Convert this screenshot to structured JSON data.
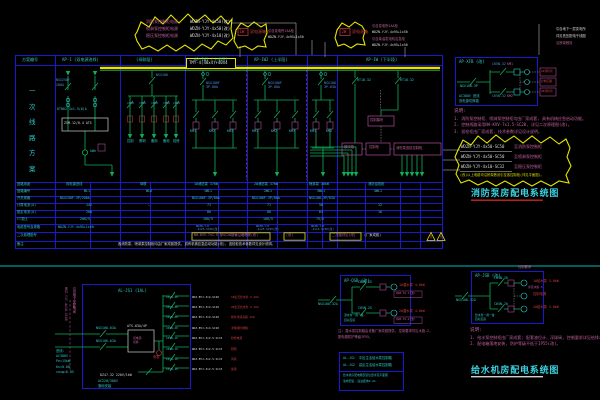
{
  "top": {
    "cloud1": {
      "l1": "消防泵控制柜电源",
      "s1": "WDZN-YJY-4x50(改)",
      "l2": "喷淋泵控制柜电源",
      "s2": "WDZN-YJY-4x50(改)",
      "l3": "稳压泵控制柜电源",
      "s3": "WDZN-YJY-4x10(改)"
    },
    "cloud2_tag": "1W",
    "cloud2_text": "双电源箱",
    "cloud3_tag": "2W",
    "cloud3_text": "双电源箱",
    "pairA1": "引自变电所1AA柜",
    "pairA2": "WDZN-YJY-4x95+1x50",
    "pairB1": "引自变电所2AA柜",
    "pairB2": "WDZN-YJY-4x95+1x50",
    "pairB3": "引自柴油发电机应急柜",
    "pairB4": "WDZN-YJY-4x95+1x50",
    "corner1": "引自地下一层变电所",
    "corner2": "详见低压配电干线图",
    "corner3": "沿桥架敷设"
  },
  "main": {
    "scheme_label": "一\n次\n线\n路\n方\n案",
    "h0": "方案编号",
    "h1": "AP-1 (双电源进线)",
    "h2": "(母联段)",
    "h3": "AP-1W1 (上半段)",
    "h4": "AP-1W2 (上半段)",
    "h5": "AP-1W (下半段)",
    "busbar_label": "TMY-4(40x4)+40x4",
    "inc_b1": "NSX250F",
    "inc_b2": "200A",
    "inc_meter": "DT862 3x1.5(6)A",
    "inc_box": "ZSM-12/0.4 ATS",
    "inc_out": "kWh",
    "f_brk": "NSX100",
    "f1": "C65N",
    "f2": "C65N",
    "f3": "C65N",
    "f4": "C65N",
    "f5": "C65N",
    "u1": "控制",
    "u2": "照明",
    "u3": "备用",
    "u4": "备用",
    "u5": "检修",
    "m1_brk": "NSX100F\n3P-80A",
    "m2_brk": "NSX100F\n3P-80A",
    "m3_brk": "NSX100\n3P-63A",
    "m1_k1": "KM1",
    "m1_k2": "KM2",
    "m1_k3": "KM3",
    "m2_k1": "KM1",
    "m2_k2": "KM2",
    "m2_k3": "KM3",
    "m3_k1": "KM1",
    "m3_k2": "KM2",
    "sub_f1": "RT18-32",
    "sub_f2": "RT18-32",
    "sub_box1": "控制模块",
    "sub_box2": "模块箱",
    "sub_box3": "控制柜",
    "sub_box4": "消防泵巡检控制柜",
    "rows": [
      {
        "label": "回路用途",
        "c": [
          "双电源进线",
          "母联",
          "1#消防泵 37kW",
          "2#消防泵 37kW",
          "喷淋泵 30kW",
          "消防巡检柜"
        ]
      },
      {
        "label": "回路编号",
        "c": [
          "WL1",
          "WL0",
          "1WL1",
          "2WL1",
          "3WL1",
          "4WL1"
        ]
      },
      {
        "label": "开关规格",
        "c": [
          "NSX250F-3P/200A",
          "",
          "NSX100F-3P/80A",
          "NSX100F-3P/80A",
          "NSX100-3P/63A",
          ""
        ]
      },
      {
        "label": "计算电流(A)",
        "c": [
          "142",
          "—",
          "71",
          "71",
          "58",
          "12"
        ]
      },
      {
        "label": "整定电流(A)",
        "c": [
          "200",
          "",
          "80",
          "80",
          "63",
          "16"
        ]
      },
      {
        "label": "CT变比",
        "c": [
          "200/5",
          "",
          "100/5",
          "100/5",
          "75/5",
          ""
        ]
      },
      {
        "label": "电缆型号及规格",
        "c": [
          "WDZN-YJY-4x95+1x50",
          "WDZN-YJY\n-4x25-SC50(改)",
          "WDZN-YJY\n-4x25-SC50(改)",
          "WDZN-YJY\n-4x16-SC40(改)"
        ]
      },
      {
        "label": "二次原理图号",
        "c": [
          "(厂家成套)"
        ]
      },
      {
        "label": "备注",
        "c": [
          "各消防泵、喷淋泵控制柜均由厂家成套提供, 具有机械应急启动功能(改), 巡检柜技术参数详见设计说明。"
        ]
      }
    ],
    "y8box1": "NH-KVV-7x1.5 穿SC20钢管沿墙暗敷(改)",
    "y8box2": "(改)",
    "y8box3": "二次图详见(改)"
  },
  "fire": {
    "box_label": "AP-XFB (改)",
    "in_brk": "NSX100-3P",
    "br1": "C65N-32",
    "km1": "KM1",
    "br2": "C65N-32",
    "km2": "KM2",
    "tag1": "1#消防泵",
    "tag2": "控制回路",
    "tag3": "2#消防泵",
    "foot": "AC380V 进线\n双电源切换箱",
    "notes_head": "说明:",
    "notes": "1. 消防泵控制柜、喷淋泵控制柜均由厂家成套, 具有机械应急启动功能。\n2. 控制线路采用NH-KVV-7x1.5-SC20, 详见二次原理图(改)。\n3. 巡检柜由厂家成套, 技术参数详见设计说明。",
    "cl_s1": "WDZN-YJY-4x50-SC50",
    "cl_l1": "至消防泵控制柜",
    "cl_s2": "WDZN-YJY-4x50-SC50",
    "cl_l2": "至喷淋泵控制柜",
    "cl_s3": "WDZN-YJY-4x10-SC32",
    "cl_l3": "至稳压泵控制柜",
    "cl_extra": "(改)以上电缆均沿桥架敷设引至各控制柜(详见平面图)。",
    "title": "消防泵房配电系统图"
  },
  "water": {
    "left": {
      "label": "AL-JS1 (1AL)",
      "in1": "NSX100-63A",
      "in2": "NSX100-63A",
      "ats": "ATS-63A/4P",
      "ats2": "双电源\n切换",
      "meter": "电表",
      "vert1": "WDZ-YJY-4x16-SC40",
      "vert2": "引自地下室配电间",
      "param": "进线:\nAC380V\nPe=15kW\nKx=0.80\ncosφ=0.85",
      "sub": "DZ47-32 220V/1kW",
      "foot": "AC220/380V\n落地安装",
      "brks": "C65N-20\nC65N-20\nC65N-20\nC65N-20\nC65N-16\nC65N-16\nC65N-16\nC65N-16",
      "specs": "WDZ-BYJ-3x4-SC20\nWDZ-BYJ-3x4-SC20\nWDZ-BYJ-3x4-SC20\nWDZ-BYJ-3x4-SC20\nWDZ-BYJ-3x2.5-SC15\nWDZ-BYJ-3x2.5-SC15\nWDZ-BYJ-3x2.5-SC15\nWDZ-BYJ-3x2.5-SC15",
      "loads": "1#生活给水泵 2.2kW\n2#生活给水泵 2.2kW\n紫外线消毒器 1kW\n浮球阀控制箱\n检修电源\n照明\n风机\n备用"
    },
    "legend": {
      "r1": "AL-JS1  中区生活给水泵控制箱",
      "r2": "AL-JS2  高区生活给水泵控制箱",
      "n1": "给水机房配电箱安装位置详见平面图",
      "n2": "落地安装, 底边距地0.2m"
    },
    "p1": {
      "label": "AP-QSB (改)",
      "in": "NSX100-32A",
      "b1": "C65N-25",
      "b2": "C65N-25",
      "load1": "1#潜水泵 4.0kW",
      "tag1": "QSB-JS-1(改)",
      "load2": "2#潜水泵 4.0kW",
      "tag2": "QSB-JS-2(改)",
      "foot": "潜水泵一用一备\n自动互投",
      "note": "注: 潜水泵控制箱由设备厂家成套提供, 控制要求详见水施-2,\n配电箱防护等级IP55。"
    },
    "p2": {
      "label": "AP-JSB (改)",
      "top": "控制要求",
      "in": "NSX100-32A",
      "b1": "C65N-20",
      "b2": "C65N-20",
      "load1": "1#给水泵 3.0kW",
      "load2": "控制电源",
      "load3": "2#给水泵 3.0kW",
      "tag1": "详见水施-5",
      "foot": "给水泵一用一备\n自动互投",
      "notes_head": "说明:",
      "notes": "1. 给水泵控制柜由厂家成套; 配套液位计、浮球阀, 控制要求详见给排水图纸。\n2. 配电箱落地安装, 防护等级不低于IP55(改)。"
    },
    "title": "给水机房配电系统图"
  }
}
